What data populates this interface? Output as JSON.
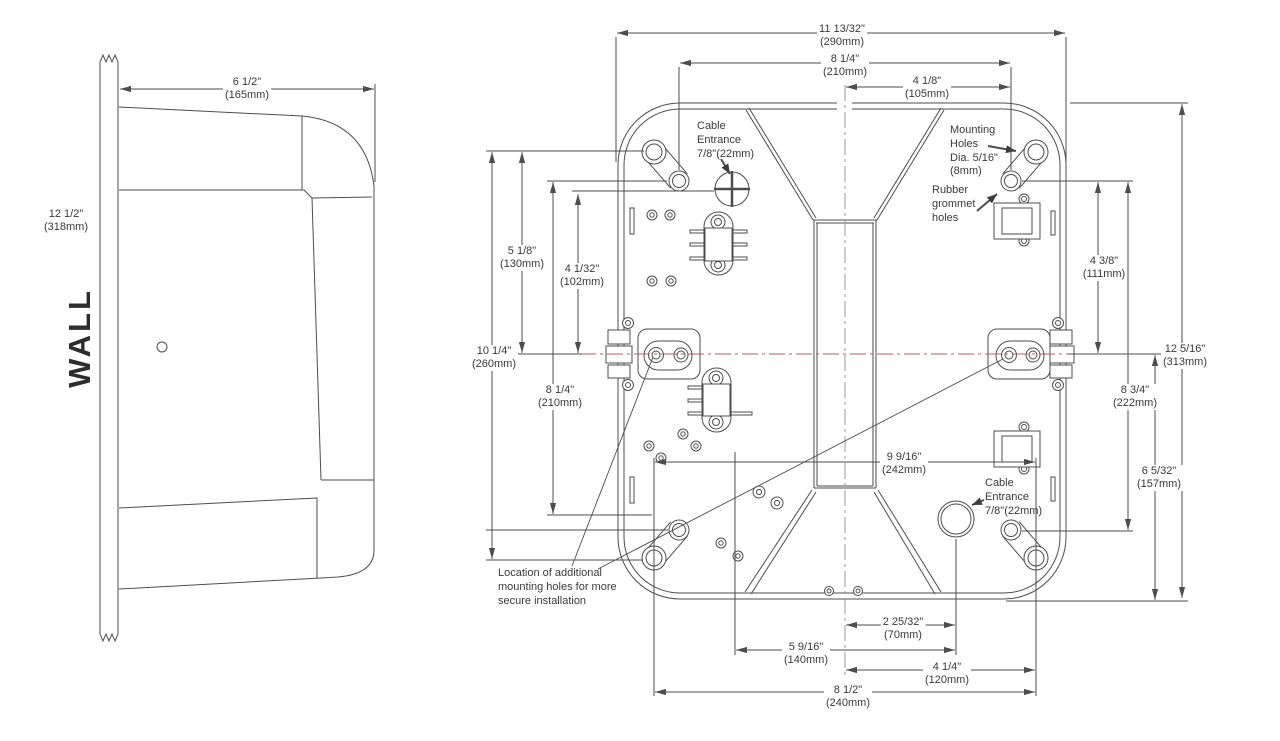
{
  "drawing": {
    "side_view": {
      "wall_label": "WALL",
      "dim_width": {
        "in": "6 1/2\"",
        "mm": "(165mm)"
      },
      "dim_height": {
        "in": "12 1/2\"",
        "mm": "(318mm)"
      }
    },
    "back_view": {
      "dims": {
        "width_overall": {
          "in": "11 13/32\"",
          "mm": "(290mm)"
        },
        "hole_span_top": {
          "in": "8 1/4\"",
          "mm": "(210mm)"
        },
        "hole_half_top": {
          "in": "4 1/8\"",
          "mm": "(105mm)"
        },
        "left_holes_outer": {
          "in": "10 1/4\"",
          "mm": "(260mm)"
        },
        "left_upper": {
          "in": "5 1/8\"",
          "mm": "(130mm)"
        },
        "left_cable_to_center": {
          "in": "4 1/32\"",
          "mm": "(102mm)"
        },
        "left_lower": {
          "in": "8 1/4\"",
          "mm": "(210mm)"
        },
        "right_upper": {
          "in": "4 3/8\"",
          "mm": "(111mm)"
        },
        "right_span": {
          "in": "8 3/4\"",
          "mm": "(222mm)"
        },
        "right_lower": {
          "in": "6 5/32\"",
          "mm": "(157mm)"
        },
        "height_overall": {
          "in": "12 5/16\"",
          "mm": "(313mm)"
        },
        "bottom_holes_span": {
          "in": "9 9/16\"",
          "mm": "(242mm)"
        },
        "bottom_cable_offset": {
          "in": "2 25/32\"",
          "mm": "(70mm)"
        },
        "bottom_mid_span": {
          "in": "5 9/16\"",
          "mm": "(140mm)"
        },
        "bottom_keyhole_offset": {
          "in": "4 1/4\"",
          "mm": "(120mm)"
        },
        "bottom_span": {
          "in": "8 1/2\"",
          "mm": "(240mm)"
        }
      },
      "labels": {
        "cable_entrance_top": {
          "l1": "Cable",
          "l2": "Entrance",
          "l3": "7/8\"(22mm)"
        },
        "mounting_holes": {
          "l1": "Mounting",
          "l2": "Holes",
          "l3": "Dia. 5/16\"",
          "l4": "(8mm)"
        },
        "rubber_grommet": {
          "l1": "Rubber",
          "l2": "grommet",
          "l3": "holes"
        },
        "cable_entrance_bottom": {
          "l1": "Cable",
          "l2": "Entrance",
          "l3": "7/8\"(22mm)"
        },
        "additional_holes": {
          "l1": "Location of additional",
          "l2": "mounting holes for more",
          "l3": "secure installation"
        }
      }
    },
    "colors": {
      "line": "#4d4d4d",
      "centerline_horizontal": "#b26060",
      "centerline_vertical": "#a89090",
      "text": "#3a3a3a",
      "background": "#ffffff"
    }
  }
}
